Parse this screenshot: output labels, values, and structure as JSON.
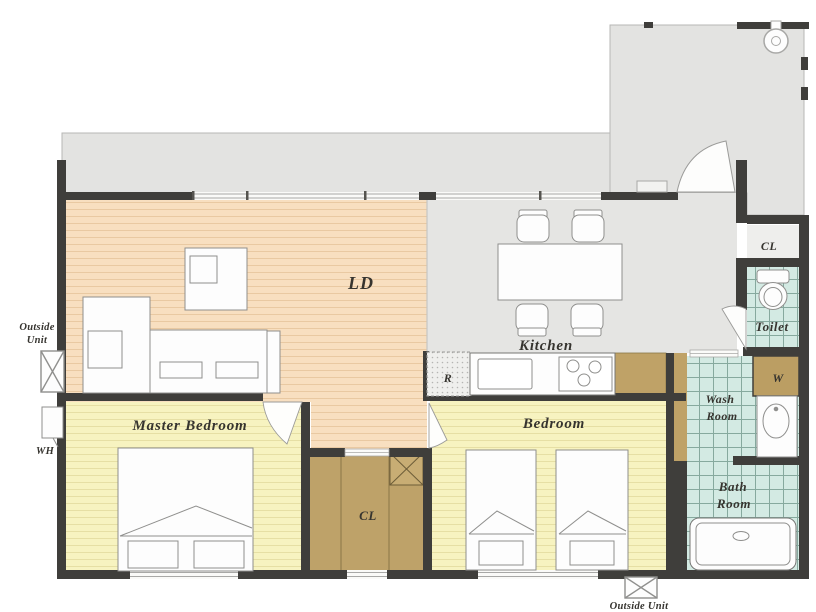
{
  "floorplan": {
    "rooms": {
      "living_dining": "LD",
      "kitchen": "Kitchen",
      "master_bedroom": "Master Bedroom",
      "bedroom": "Bedroom",
      "closet_center": "CL",
      "closet_entry": "CL",
      "toilet": "Toilet",
      "wash_room": [
        "Wash",
        "Room"
      ],
      "bath_room": [
        "Bath",
        "Room"
      ]
    },
    "fixtures": {
      "refrigerator": "R",
      "washer": "W",
      "water_heater": "WH",
      "outside_unit_left": [
        "Outside",
        "Unit"
      ],
      "outside_unit_bottom": "Outside Unit"
    },
    "colors": {
      "wall": "#3f3e3b",
      "ld_floor": "#f8dfc0",
      "bedroom_floor": "#f7f3c0",
      "tile_floor": "#d3eae3",
      "closet_fill": "#bea269",
      "balcony_floor": "#e3e3e1",
      "label_text": "#36342f"
    }
  }
}
